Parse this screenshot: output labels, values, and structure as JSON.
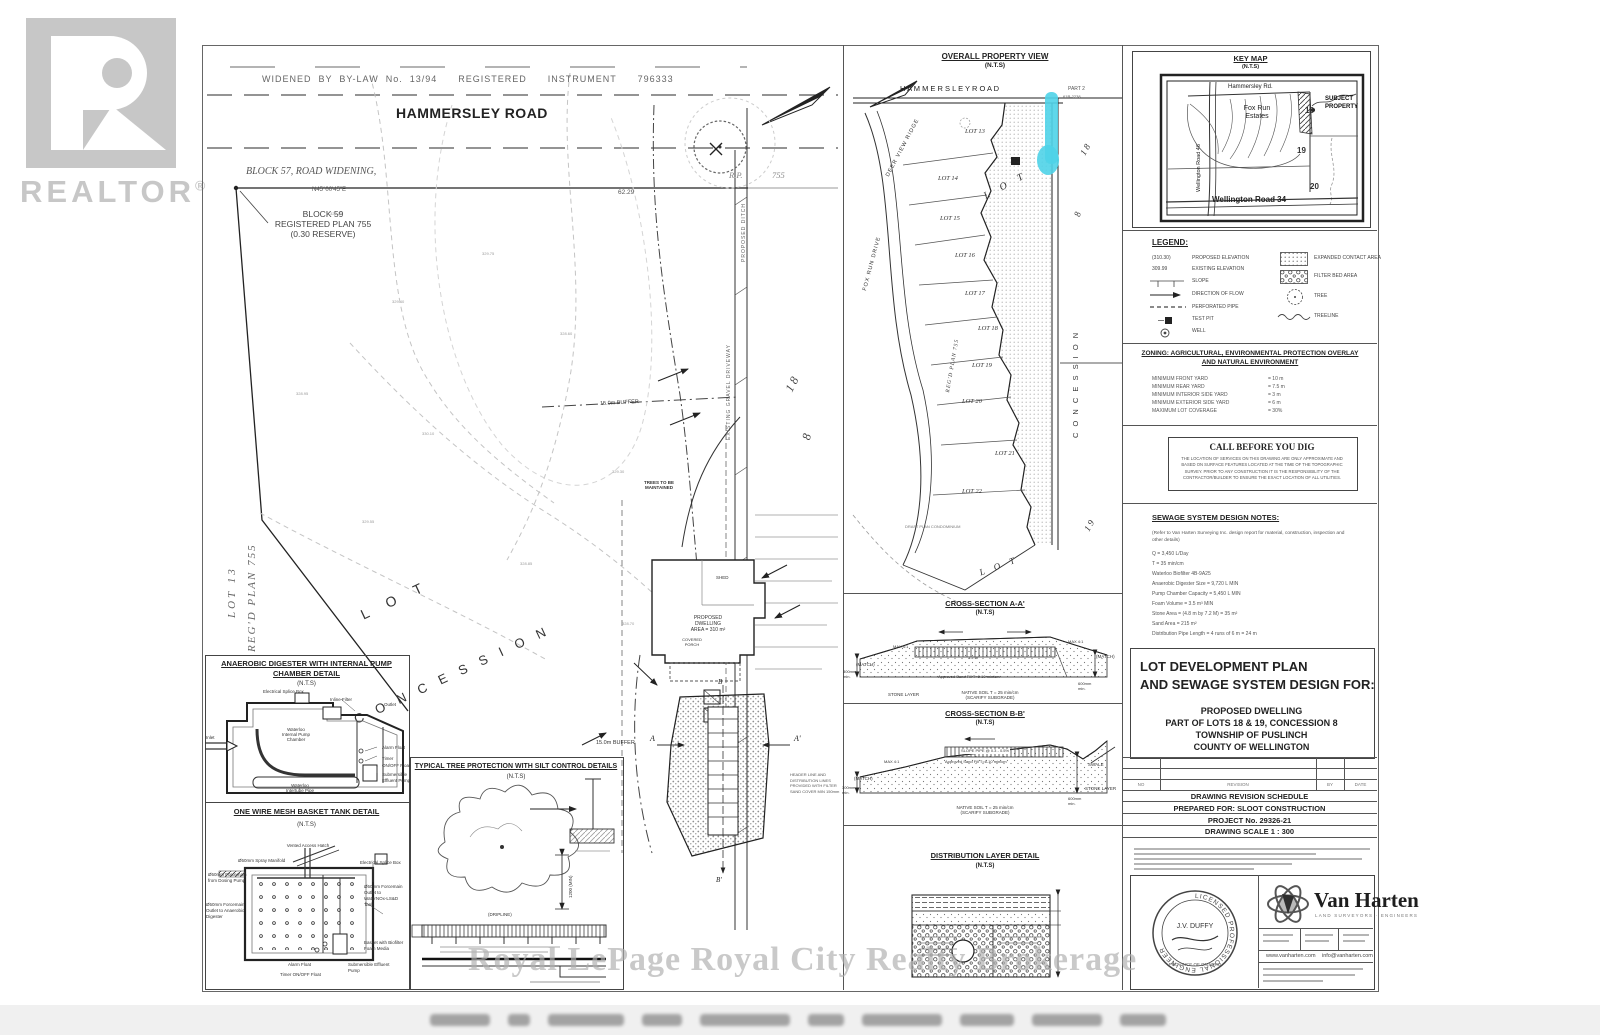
{
  "nts": "(N.T.S)",
  "watermark": {
    "realtor": "REALTOR",
    "reg": "®",
    "brokerage": "Royal LePage Royal City Realty Brokerage"
  },
  "main_plan": {
    "bylaw_text": "WIDENED  BY  BY-LAW  No.  13/94      REGISTERED      INSTRUMENT      796333",
    "road": "HAMMERSLEY ROAD",
    "block57": "BLOCK 57, ROAD WIDENING,",
    "bearing": "N45°00'45\"E",
    "distance": "62.29",
    "block59_1": "BLOCK 59",
    "block59_2": "REGISTERED PLAN 755",
    "block59_3": "(0.30 RESERVE)",
    "rp": "R.P.",
    "rp_num": "755",
    "lot13": "LOT 13",
    "regd_plan": "REG'D PLAN 755",
    "lot_word": "L O T",
    "concession_word": "C O N C E S S I O N",
    "lot_no": "1 8",
    "con_no": "8",
    "drive_label": "EXISTING GRAVEL DRIVEWAY",
    "ditch_label": "PROPOSED DITCH",
    "trees_1": "TREES TO BE",
    "trees_2": "MAINTAINED",
    "dwelling_1": "PROPOSED",
    "dwelling_2": "DWELLING",
    "dwelling_3": "AREA = 310 m²",
    "shed": "SHED",
    "porch_1": "COVERED",
    "porch_2": "PORCH",
    "buffer_a": "15.0m BUFFER",
    "buffer_b": "15.0m BUFFER",
    "sec_a": "A",
    "sec_a2": "A'",
    "sec_b": "B",
    "sec_b2": "B'",
    "header_note_1": "HEADER LINE AND",
    "header_note_2": "DISTRIBUTION LINES",
    "header_note_3": "PROVIDED WITH FILTER",
    "header_note_4": "SAND COVER MIN 150mm",
    "elevations": [
      "329.15",
      "329.40",
      "328.95",
      "330.10",
      "329.75",
      "328.60",
      "329.30",
      "328.85",
      "329.55",
      "328.70"
    ]
  },
  "digester_detail": {
    "title_1": "ANAEROBIC DIGESTER WITH INTERNAL PUMP",
    "title_2": "CHAMBER DETAIL",
    "inlet": "Inlet",
    "splice": "Electrical Splice Box",
    "filter": "Inline Filter",
    "outlet": "Outlet",
    "chamber_1": "Waterloo",
    "chamber_2": "Internal Pump",
    "chamber_3": "Chamber",
    "alarm": "Alarm Float",
    "timer": "Timer",
    "onoff_1": "ON/OFF",
    "onoff_2": "Float",
    "pump_1": "Submersible",
    "pump_2": "Effluent Pump",
    "pipe_1": "Waterloo",
    "pipe_2": "Intertube Pipe"
  },
  "basket_detail": {
    "title": "ONE WIRE MESH BASKET TANK DETAIL",
    "hatch": "Vented Access Hatch",
    "manifold": "Ø50mm Spray Manifold",
    "splice": "Electrical Splice Box",
    "fm_dosing_1": "Ø50mm Forcemain",
    "fm_dosing_2": "from Dosing Pump",
    "fm_tank_1": "Ø50mm Forcemain",
    "fm_tank_2": "Outlet to",
    "fm_tank_3": "WaterNOx-LS&D",
    "fm_tank_4": "Tank",
    "fm_dig_1": "Ø50mm Forcemain",
    "fm_dig_2": "Outlet to Anaerobic",
    "fm_dig_3": "Digester",
    "basket_1": "Basket with Biofilter",
    "basket_2": "Foam Media",
    "alarm": "Alarm Float",
    "timer": "Timer ON/OFF Float",
    "pump_1": "Submersible Effluent",
    "pump_2": "Pump"
  },
  "tree_detail": {
    "title": "TYPICAL TREE PROTECTION WITH SILT CONTROL DETAILS",
    "dim": "1200 (MIN)",
    "dripline": "(DRIPLINE)"
  },
  "overall_view": {
    "title": "OVERALL PROPERTY VIEW",
    "road": "H A M M E R S L E Y    R O A D",
    "part_1": "PART 2",
    "part_2": "61R-2238",
    "lots": [
      "LOT 13",
      "LOT 14",
      "LOT 15",
      "LOT 16",
      "LOT 17",
      "LOT 18",
      "LOT 19",
      "LOT 20",
      "LOT 21",
      "LOT 22"
    ],
    "deer": "DEER VIEW RIDGE",
    "fox": "FOX RUN DRIVE",
    "regd": "REG'D PLAN 755",
    "lot_word": "L O T",
    "con_word": "C O N C E S S I O N",
    "no18": "1 8",
    "no8": "8",
    "no19": "1 9",
    "lot_word2": "L O T",
    "draft": "DRAFT PLAN CONDOMINIUM"
  },
  "xsec_a": {
    "title": "CROSS-SECTION A-A'",
    "match_l": "(MATCH)",
    "match_r": "(MATCH)",
    "max_l": "MAX 4:1",
    "max_r": "MAX 4:1",
    "h300": "300mm",
    "min": "min.",
    "mound": "1.2 m",
    "sand": "Approved Sand Fill T=6-10 min/cm",
    "stone": "STONE LAYER",
    "native": "NATIVE SOIL T = 25 min/cm",
    "scarify": "(SCARIFY SUBGRADE)",
    "h600": "600mm"
  },
  "xsec_b": {
    "title": "CROSS-SECTION B-B'",
    "match": "(MATCH)",
    "max": "MAX 4:1",
    "h300": "300mm",
    "min": "min.",
    "slope": "SLOPE PIPE @ 0.3 - 0.5%",
    "sand": "Approved Sand Fill T=6-10 min/cm",
    "swale": "SWALE",
    "stone": "STONE LAYER",
    "h600": "600mm",
    "native": "NATIVE SOIL T = 25 min/cm",
    "scarify": "(SCARIFY SUBGRADE)"
  },
  "dist_detail": {
    "title": "DISTRIBUTION LAYER DETAIL"
  },
  "key_map": {
    "title": "KEY MAP",
    "hammersley": "Hammersley Rd.",
    "wellington46": "Wellington Road 46",
    "fox_1": "Fox Run",
    "fox_2": "Estates",
    "subject_1": "SUBJECT",
    "subject_2": "PROPERTY",
    "n18": "18",
    "n19": "19",
    "n20": "20",
    "wellington34": "Wellington Road 34"
  },
  "legend": {
    "title": "LEGEND:",
    "left": [
      {
        "sym": "(310.30)",
        "label": "PROPOSED ELEVATION"
      },
      {
        "sym": "309.99",
        "label": "EXISTING ELEVATION"
      },
      {
        "sym": "",
        "label": "SLOPE"
      },
      {
        "sym": "",
        "label": "DIRECTION OF FLOW"
      },
      {
        "sym": "",
        "label": "PERFORATED PIPE"
      },
      {
        "sym": "",
        "label": "TEST PIT"
      },
      {
        "sym": "",
        "label": "WELL"
      }
    ],
    "right": [
      {
        "label": "EXPANDED CONTACT AREA"
      },
      {
        "label": "FILTER BED AREA"
      },
      {
        "label": "TREE"
      },
      {
        "label": "TREELINE"
      }
    ]
  },
  "zoning": {
    "title_1": "ZONING: AGRICULTURAL, ENVIRONMENTAL PROTECTION OVERLAY",
    "title_2": "AND NATURAL ENVIRONMENT",
    "rows": [
      {
        "label": "MINIMUM FRONT YARD",
        "value": "= 10 m"
      },
      {
        "label": "MINIMUM REAR YARD",
        "value": "= 7.5 m"
      },
      {
        "label": "MINIMUM INTERIOR SIDE YARD",
        "value": "= 3 m"
      },
      {
        "label": "MINIMUM EXTERIOR SIDE YARD",
        "value": "= 6 m"
      },
      {
        "label": "MAXIMUM LOT COVERAGE",
        "value": "= 30%"
      }
    ]
  },
  "call_dig": {
    "title": "CALL BEFORE YOU DIG",
    "body": "THE LOCATION OF SERVICES ON THIS DRAWING ARE ONLY APPROXIMATE AND BASED ON SURFACE FEATURES LOCATED AT THE TIME OF THE TOPOGRAPHIC SURVEY.  PRIOR TO ANY CONSTRUCTION IT IS THE RESPONSIBILITY OF THE CONTRACTOR/BUILDER TO ENSURE THE EXACT LOCATION OF ALL UTILITIES."
  },
  "sewage_notes": {
    "title": "SEWAGE SYSTEM DESIGN NOTES:",
    "intro_1": "(Refer to Van Harten Surveying Inc. design report for material, construction, inspection and",
    "intro_2": "other details)",
    "lines": [
      "Q = 3,450 L/Day",
      "T = 35 min/cm",
      "Waterloo Biofilter 4B-9A25",
      "Anaerobic Digester Size = 9,720 L MIN",
      "Pump Chamber Capacity = 5,450 L MIN",
      "Foam Volume = 3.5 m³ MIN",
      "Stone Area = (4.8 m by 7.2 M) = 35 m²",
      "Sand Area = 215 m²",
      "Distribution Pipe Length = 4 runs of 6 m = 24 m"
    ]
  },
  "title_block": {
    "line_1": "LOT DEVELOPMENT PLAN",
    "line_2": "AND SEWAGE SYSTEM DESIGN FOR:",
    "for_1": "PROPOSED DWELLING",
    "for_2": "PART OF LOTS 18 & 19, CONCESSION 8",
    "for_3": "TOWNSHIP OF PUSLINCH",
    "for_4": "COUNTY OF WELLINGTON"
  },
  "revision": {
    "cols": [
      "NO",
      "REVISION",
      "BY",
      "DATE"
    ],
    "bars": [
      "DRAWING REVISION SCHEDULE",
      "PREPARED FOR: SLOOT CONSTRUCTION",
      "PROJECT No. 29326-21",
      "DRAWING SCALE 1 : 300"
    ]
  },
  "van_harten": {
    "name": "Van Harten",
    "tagline": "LAND SURVEYORS · ENGINEERS",
    "web": "www.vanharten.com",
    "email": "info@vanharten.com",
    "seal_top": "LICENSED PROFESSIONAL ENGINEER",
    "seal_name": "J.V. DUFFY",
    "seal_bottom": "PROVINCE OF ONTARIO"
  },
  "colors": {
    "highlight": "#4fd3e8",
    "ink": "#2a2a2a",
    "faint": "#c7c7c7"
  }
}
